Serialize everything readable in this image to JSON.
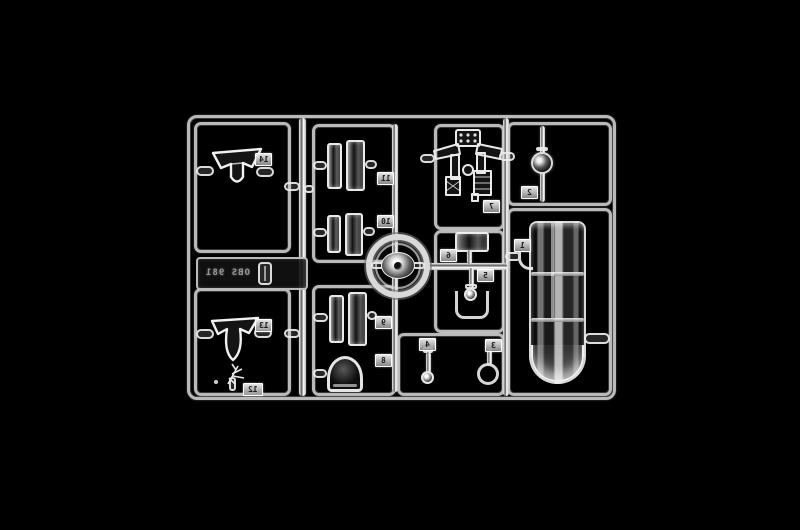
{
  "image": {
    "type": "photograph",
    "subject": "Clear transparent plastic model-kit sprue (clear parts tree) photographed on a black background",
    "background_color": "#000000",
    "plastic_color": "#e8e8e8"
  },
  "sprue": {
    "mold_code": "OBS 981",
    "parts": [
      {
        "number": "1",
        "shape": "large-cylindrical-clear-section"
      },
      {
        "number": "2",
        "shape": "small-dome-lens"
      },
      {
        "number": "3",
        "shape": "open-ring"
      },
      {
        "number": "4",
        "shape": "stem-with-ball-lens"
      },
      {
        "number": "5",
        "shape": "small-stem-part"
      },
      {
        "number": "6",
        "shape": "rectangular-window"
      },
      {
        "number": "7",
        "shape": "cockpit-interior-assembly"
      },
      {
        "number": "8",
        "shape": "bubble-dome"
      },
      {
        "number": "9",
        "shape": "side-window-pair"
      },
      {
        "number": "10",
        "shape": "side-window-pair"
      },
      {
        "number": "11",
        "shape": "side-window-pair"
      },
      {
        "number": "12",
        "shape": "small-sprig"
      },
      {
        "number": "13",
        "shape": "windshield-canopy"
      },
      {
        "number": "14",
        "shape": "windshield-canopy"
      }
    ]
  }
}
